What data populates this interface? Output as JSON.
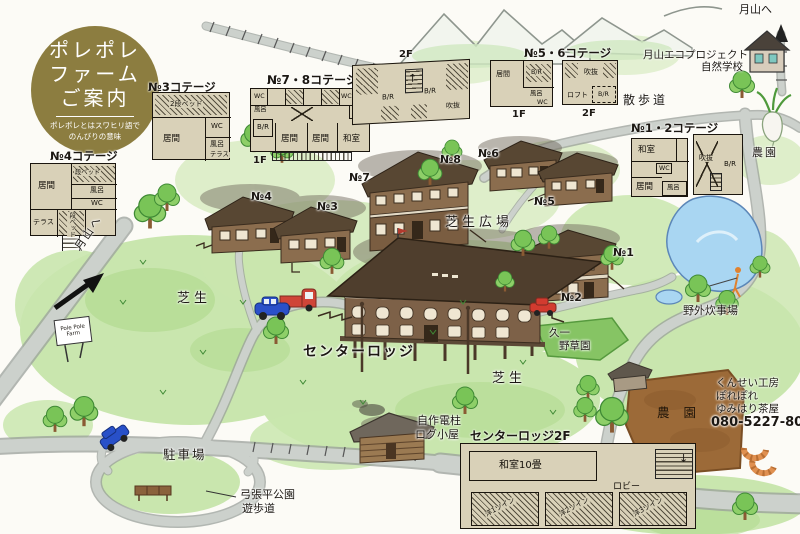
{
  "logo": {
    "line1": "ポレポレ",
    "line2": "ファーム",
    "line3": "ご案内",
    "sub1": "ポレポレとはスワヒリ語で",
    "sub2": "のんびりの意味"
  },
  "floors": {
    "f1": "1F",
    "f2": "2F"
  },
  "icons": {
    "stairs_down": "↓",
    "stairs_up": "↑"
  },
  "plans": {
    "no4": {
      "title": "№4コテージ",
      "rooms": [
        "居間",
        "段ベッド",
        "風呂",
        "WC",
        "テラス",
        "段ベッド"
      ]
    },
    "no3": {
      "title": "№3コテージ",
      "rooms": [
        "2段ベッド",
        "WC",
        "居間",
        "風呂",
        "テラス"
      ]
    },
    "no78": {
      "title": "№7・8コテージ",
      "rooms1": [
        "WC",
        "風呂",
        "B/R",
        "居間",
        "居間",
        "和室",
        "風呂",
        "WC"
      ],
      "rooms2": [
        "B/R",
        "B/R",
        "吹抜"
      ]
    },
    "no56": {
      "title": "№5・6コテージ",
      "rooms1": [
        "居間",
        "B/R",
        "風呂",
        "WC"
      ],
      "rooms2": [
        "吹抜",
        "ロフト",
        "B/R"
      ]
    },
    "no12": {
      "title": "№1・2コテージ",
      "rooms1": [
        "和室",
        "WC",
        "居間",
        "風呂"
      ],
      "rooms2": [
        "吹抜",
        "B/R"
      ]
    },
    "lodge2f": {
      "title": "センターロッジ2F",
      "rooms": [
        "和室10畳",
        "ロビー",
        "洋1ツイン",
        "洋2ツイン",
        "洋3ツイン"
      ]
    }
  },
  "markers": [
    "№4",
    "№3",
    "№7",
    "№8",
    "№6",
    "№5",
    "№1",
    "№2"
  ],
  "labels": {
    "to_gassan_top": "月山へ",
    "to_gassan_left": "月山へ",
    "eco1": "月山エコプロジェクト",
    "eco2": "自然学校",
    "sanpomichi": "散歩道",
    "nouen_right": "農園",
    "lawn_plaza": "芝生広場",
    "lawn_left": "芝生",
    "lawn_bottom": "芝生",
    "center_lodge": "センターロッジ",
    "cooking": "野外炊事場",
    "garden1": "久一",
    "garden2": "野草園",
    "nouen_field": "農 園",
    "smoke1": "くんせい工房",
    "smoke2": "ぽれぽれ",
    "smoke3": "ゆみはり茶屋",
    "phone": "080-5227-8059",
    "logcabin1": "自作電柱",
    "logcabin2": "ログ小屋",
    "parking": "駐車場",
    "park1": "弓張平公園",
    "park2": "遊歩道",
    "sign": "Pole Pole Farm"
  },
  "colors": {
    "logo_bg": "#8C7D40",
    "grass": "#C9E6AE",
    "road": "#CCD1CC",
    "water": "#A9D6F2",
    "building": "#8B6D4E",
    "roof": "#4F3E2D",
    "field": "#9C6A38",
    "plan_bg": "#D9D1B8"
  }
}
